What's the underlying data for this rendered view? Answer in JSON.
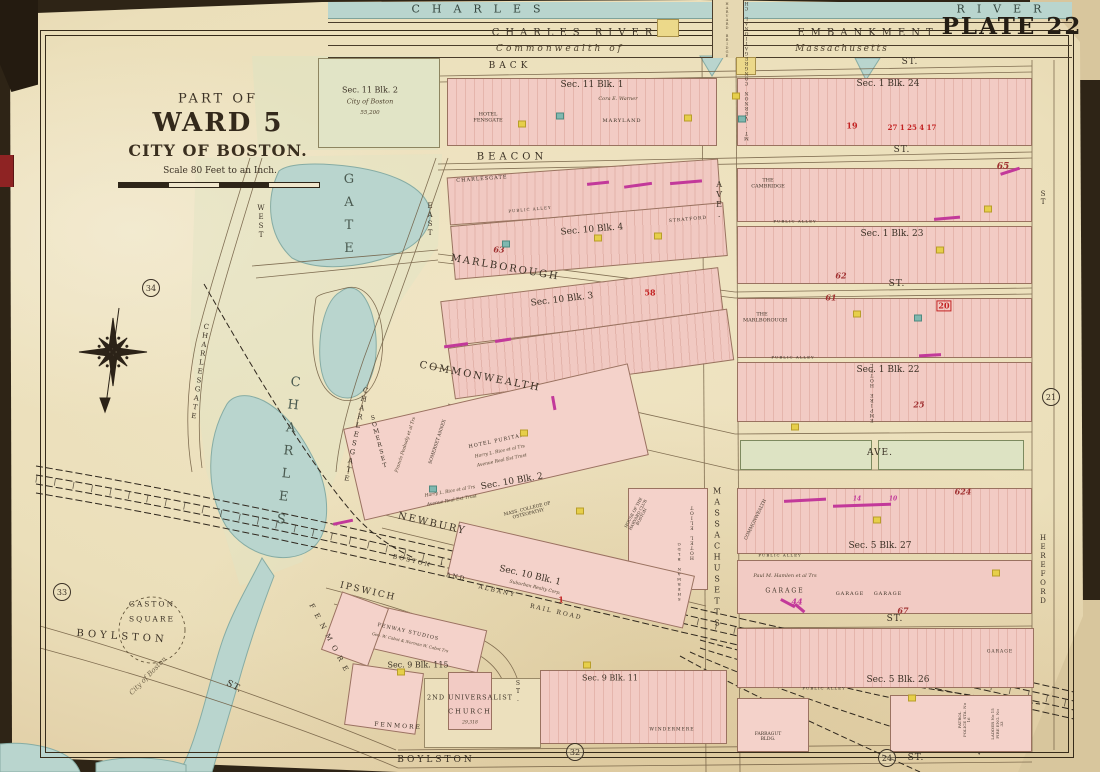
{
  "header": {
    "plate": "PLATE 22",
    "river_word1": "CHARLES",
    "river_word2": "RIVER",
    "embankment_word1": "CHARLES RIVER",
    "embankment_word2": "EMBANKMENT",
    "commonwealth_of": "Commonwealth of",
    "massachusetts": "Massachusetts",
    "harvard_bridge": "HARVARD BRIDGE"
  },
  "title_block": {
    "part_of": "PART OF",
    "ward": "WARD 5",
    "city": "CITY OF BOSTON.",
    "scale": "Scale 80 Feet to an Inch."
  },
  "plate_refs": {
    "upper_left": "34",
    "lower_left": "33",
    "right": "21",
    "bottom_center": "32",
    "bottom_right": "24"
  },
  "streets": {
    "back": "BACK",
    "beacon": "BEACON",
    "marlborough": "MARLBOROUGH",
    "commonwealth": "COMMONWEALTH",
    "newbury": "NEWBURY",
    "ipswich": "IPSWICH",
    "boylston": "BOYLSTON",
    "boylston2": "BOYLSTON",
    "massachusetts": "MASSACHUSETTS",
    "hereford": "HEREFORD",
    "charlesgate_west_name": "CHARLESGATE",
    "west": "WEST",
    "charlesgate_east_name": "CHARLESGATE",
    "east": "EAST",
    "fenmore": "FENMORE",
    "ave": "AVE.",
    "st": "ST.",
    "st_plain": "ST",
    "public_alley": "PUBLIC ALLEY"
  },
  "railroad": {
    "boston": "BOSTON",
    "and": "AND",
    "albany": "ALBANY",
    "rail_road": "RAIL ROAD"
  },
  "park": {
    "gate": "GATE",
    "charles": "CHARLES",
    "gaston": "GASTON",
    "square": "SQUARE",
    "city_of_boston": "City of Boston"
  },
  "sections": {
    "s11b2": "Sec. 11 Blk. 2",
    "s11b1": "Sec. 11 Blk. 1",
    "s1b24": "Sec. 1 Blk. 24",
    "s10b4": "Sec. 10 Blk. 4",
    "s1b23": "Sec. 1 Blk. 23",
    "s10b3": "Sec. 10 Blk. 3",
    "s1b22": "Sec. 1 Blk. 22",
    "s10b2": "Sec. 10 Blk. 2",
    "s5b27": "Sec. 5 Blk. 27",
    "s10b1": "Sec. 10 Blk. 1",
    "s9b115": "Sec. 9 Blk. 115",
    "s9b11": "Sec. 9 Blk. 11",
    "s5b26": "Sec. 5 Blk. 26"
  },
  "buildings": {
    "city_of_boston": "City of Boston",
    "area_55200": "55,200",
    "hotel_fensgate": "HOTEL FENSGATE",
    "cora_warner": "Cora E. Warner",
    "maryland": "MARYLAND",
    "mt_vernon": "MT. VERNON CONGREGATIONAL CHURCH",
    "the_cambridge": "THE CAMBRIDGE",
    "charlesgate_hotel": "CHARLESGATE",
    "stratford": "STRATFORD",
    "the_marlborough": "THE MARLBOROUGH",
    "empire_hotel": "EMPIRE HOTEL",
    "somerset": "SOMERSET",
    "somerset_annex": "SOMERSET ANNEX",
    "francis_peabody": "Francis Peabody et al Trs",
    "hotel_puritan": "HOTEL PURITAN",
    "harry_rice": "Harry L. Rice et al Trs",
    "avenue_trust": "Avenue Real Est Trust",
    "mass_college": "MASS. COLLEGE OF OSTEOPATHY",
    "hotel_eliot": "HOTEL ELIOT",
    "sherman": "SHERMAN BLDG",
    "harvard_club": "HOUSE OF THE HARVARD CLUB BOSTON",
    "suburban": "Suburban Realty Corp.",
    "commonwealth_bldg": "COMMONWEALTH",
    "hamlen": "Paul M. Hamlen et al Trs",
    "garage": "GARAGE",
    "fenway_studios": "FENWAY STUDIOS",
    "cabot": "Geo. W. Cabot & Norman W. Cabot Trs",
    "universalist": "2ND UNIVERSALIST",
    "church": "CHURCH",
    "church_area": "29,318",
    "windermere": "WINDERMERE",
    "fenmore_bldg": "FENMORE",
    "police": "PATROL POLICE STA. No 16",
    "ladder": "LADDER No 15 FIRE ENG. No 33",
    "farragut": "FARRAGUT BLDG."
  },
  "annotations": {
    "n19": "19",
    "n27": "27 1 25 4 17",
    "n63": "63",
    "n58": "58",
    "n62": "62",
    "n61": "61",
    "n65": "65",
    "n20": "20",
    "n25": "25",
    "n67": "67",
    "n44": "44",
    "n624": "624",
    "n1": "1",
    "n14": "14",
    "n10": "10"
  },
  "marks": {
    "yellow": [
      [
        522,
        124
      ],
      [
        688,
        118
      ],
      [
        598,
        238
      ],
      [
        658,
        236
      ],
      [
        940,
        250
      ],
      [
        988,
        209
      ],
      [
        524,
        433
      ],
      [
        580,
        511
      ],
      [
        877,
        520
      ],
      [
        996,
        573
      ],
      [
        912,
        698
      ],
      [
        587,
        665
      ],
      [
        401,
        672
      ],
      [
        795,
        427
      ],
      [
        857,
        314
      ],
      [
        736,
        96
      ]
    ],
    "teal": [
      [
        560,
        116
      ],
      [
        506,
        244
      ],
      [
        742,
        119
      ],
      [
        918,
        318
      ],
      [
        433,
        489
      ]
    ],
    "magenta": [
      [
        598,
        183,
        22,
        -6
      ],
      [
        638,
        185,
        28,
        -8
      ],
      [
        686,
        182,
        32,
        -5
      ],
      [
        503,
        340,
        16,
        -9
      ],
      [
        456,
        345,
        24,
        -8
      ],
      [
        805,
        500,
        42,
        -3
      ],
      [
        862,
        505,
        58,
        -2
      ],
      [
        788,
        603,
        16,
        28
      ],
      [
        343,
        522,
        20,
        -12
      ],
      [
        947,
        218,
        26,
        -5
      ],
      [
        1010,
        171,
        20,
        -18
      ],
      [
        930,
        355,
        22,
        -3
      ],
      [
        554,
        403,
        14,
        80
      ],
      [
        800,
        608,
        12,
        40
      ]
    ]
  }
}
